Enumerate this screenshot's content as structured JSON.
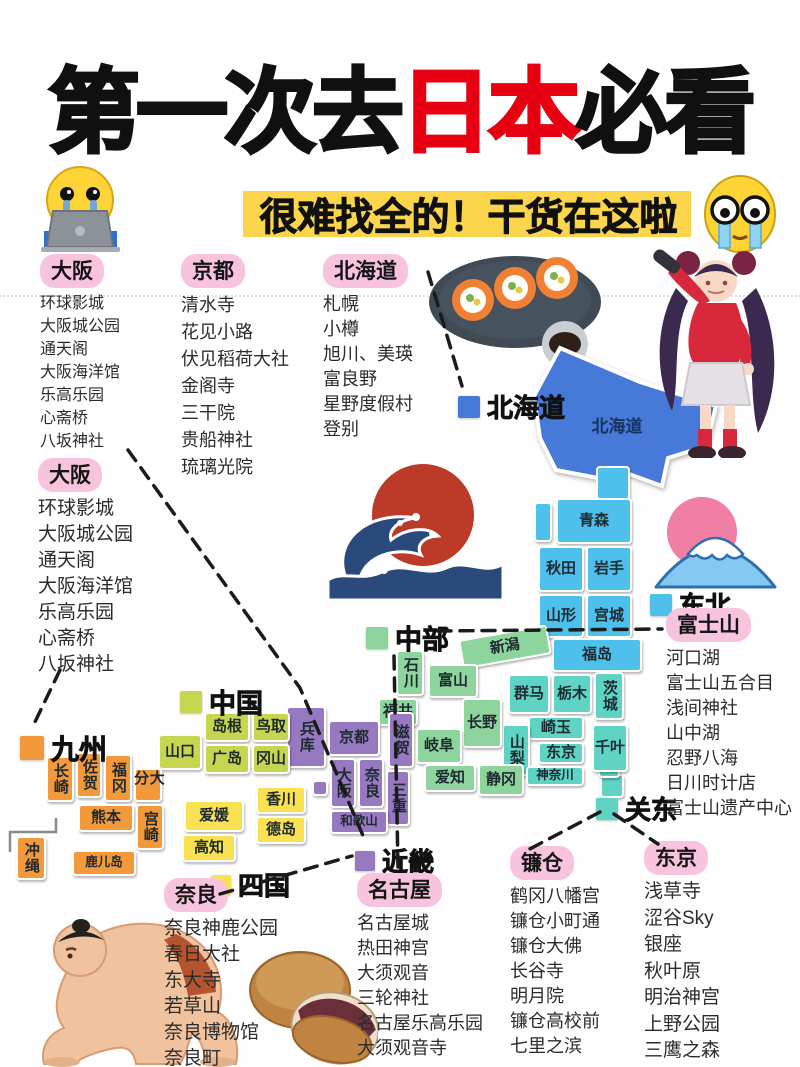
{
  "title": {
    "prefix": "第一次去",
    "highlight": "日本",
    "suffix": "必看"
  },
  "subtitle": "很难找全的！干货在这啦",
  "colors": {
    "title_accent": "#e60012",
    "subtitle_highlight": "#fbd54b",
    "pill_pink": "#f8c3dc",
    "regions": {
      "hokkaido": "#4679d8",
      "tohoku": "#4dc0ec",
      "kanto": "#5fd4c5",
      "chubu": "#8ed49d",
      "kinki": "#9779c1",
      "chugoku": "#c7d650",
      "shikoku": "#f8e254",
      "kyushu": "#f2993b"
    }
  },
  "lists": [
    {
      "id": "osaka1",
      "label": "大阪",
      "items": [
        "环球影城",
        "大阪城公园",
        "通天阁",
        "大阪海洋馆",
        "乐高乐园",
        "心斋桥",
        "八坂神社"
      ]
    },
    {
      "id": "kyoto",
      "label": "京都",
      "items": [
        "清水寺",
        "花见小路",
        "伏见稻荷大社",
        "金阁寺",
        "三干院",
        "贵船神社",
        "琉璃光院"
      ]
    },
    {
      "id": "hokkaido",
      "label": "北海道",
      "items": [
        "札幌",
        "小樽",
        "旭川、美瑛",
        "富良野",
        "星野度假村",
        "登别"
      ]
    },
    {
      "id": "osaka2",
      "label": "大阪",
      "items": [
        "环球影城",
        "大阪城公园",
        "通天阁",
        "大阪海洋馆",
        "乐高乐园",
        "心斋桥",
        "八坂神社"
      ]
    },
    {
      "id": "fuji",
      "label": "富士山",
      "items": [
        "河口湖",
        "富士山五合目",
        "浅间神社",
        "山中湖",
        "忍野八海",
        "日川时计店",
        "富士山遗产中心"
      ]
    },
    {
      "id": "kamakura",
      "label": "镰仓",
      "items": [
        "鹤冈八幡宫",
        "镰仓小町通",
        "镰仓大佛",
        "长谷寺",
        "明月院",
        "镰仓高校前",
        "七里之滨"
      ]
    },
    {
      "id": "tokyo",
      "label": "东京",
      "items": [
        "浅草寺",
        "涩谷Sky",
        "银座",
        "秋叶原",
        "明治神宫",
        "上野公园",
        "三鹰之森"
      ]
    },
    {
      "id": "nagoya",
      "label": "名古屋",
      "items": [
        "名古屋城",
        "热田神宫",
        "大须观音",
        "三轮神社",
        "名古屋乐高乐园",
        "大须观音寺"
      ]
    },
    {
      "id": "nara",
      "label": "奈良",
      "items": [
        "奈良神鹿公园",
        "春日大社",
        "东大寺",
        "若草山",
        "奈良博物馆",
        "奈良町"
      ]
    }
  ],
  "legends": [
    {
      "id": "hokkaido",
      "label": "北海道"
    },
    {
      "id": "tohoku",
      "label": "东北"
    },
    {
      "id": "chubu",
      "label": "中部"
    },
    {
      "id": "chugoku",
      "label": "中国"
    },
    {
      "id": "kyushu",
      "label": "九州"
    },
    {
      "id": "shikoku",
      "label": "四国"
    },
    {
      "id": "kinki",
      "label": "近畿"
    },
    {
      "id": "kanto",
      "label": "关东"
    }
  ],
  "map": {
    "hokkaido_label": "北海道",
    "prefectures": [
      {
        "name": "青森",
        "region": "tohoku"
      },
      {
        "name": "秋田",
        "region": "tohoku"
      },
      {
        "name": "岩手",
        "region": "tohoku"
      },
      {
        "name": "山形",
        "region": "tohoku"
      },
      {
        "name": "宫城",
        "region": "tohoku"
      },
      {
        "name": "福岛",
        "region": "tohoku"
      },
      {
        "name": "群马",
        "region": "kanto"
      },
      {
        "name": "栃木",
        "region": "kanto"
      },
      {
        "name": "茨城",
        "region": "kanto"
      },
      {
        "name": "崎玉",
        "region": "kanto"
      },
      {
        "name": "山梨",
        "region": "kanto"
      },
      {
        "name": "东京",
        "region": "kanto"
      },
      {
        "name": "神奈川",
        "region": "kanto"
      },
      {
        "name": "千叶",
        "region": "kanto"
      },
      {
        "name": "新潟",
        "region": "chubu"
      },
      {
        "name": "石川",
        "region": "chubu"
      },
      {
        "name": "富山",
        "region": "chubu"
      },
      {
        "name": "福井",
        "region": "chubu"
      },
      {
        "name": "长野",
        "region": "chubu"
      },
      {
        "name": "岐阜",
        "region": "chubu"
      },
      {
        "name": "爱知",
        "region": "chubu"
      },
      {
        "name": "静冈",
        "region": "chubu"
      },
      {
        "name": "兵库",
        "region": "kinki"
      },
      {
        "name": "京都",
        "region": "kinki"
      },
      {
        "name": "滋贺",
        "region": "kinki"
      },
      {
        "name": "大阪",
        "region": "kinki"
      },
      {
        "name": "奈良",
        "region": "kinki"
      },
      {
        "name": "三重",
        "region": "kinki"
      },
      {
        "name": "和歌山",
        "region": "kinki"
      },
      {
        "name": "山口",
        "region": "chugoku"
      },
      {
        "name": "岛根",
        "region": "chugoku"
      },
      {
        "name": "鸟取",
        "region": "chugoku"
      },
      {
        "name": "广岛",
        "region": "chugoku"
      },
      {
        "name": "冈山",
        "region": "chugoku"
      },
      {
        "name": "爱媛",
        "region": "shikoku"
      },
      {
        "name": "香川",
        "region": "shikoku"
      },
      {
        "name": "德岛",
        "region": "shikoku"
      },
      {
        "name": "高知",
        "region": "shikoku"
      },
      {
        "name": "长崎",
        "region": "kyushu"
      },
      {
        "name": "佐贺",
        "region": "kyushu"
      },
      {
        "name": "福冈",
        "region": "kyushu"
      },
      {
        "name": "大分",
        "region": "kyushu"
      },
      {
        "name": "熊本",
        "region": "kyushu"
      },
      {
        "name": "宫崎",
        "region": "kyushu"
      },
      {
        "name": "鹿儿岛",
        "region": "kyushu"
      },
      {
        "name": "冲绳",
        "region": "kyushu"
      }
    ]
  },
  "illustrations": [
    "crying-emoji-with-laptop",
    "teary-big-eyes-emoji",
    "sushi-plate",
    "anime-girl-with-microphone",
    "great-wave-with-sun",
    "mount-fuji-icon",
    "sumo-wrestler",
    "dorayaki-pancakes"
  ]
}
